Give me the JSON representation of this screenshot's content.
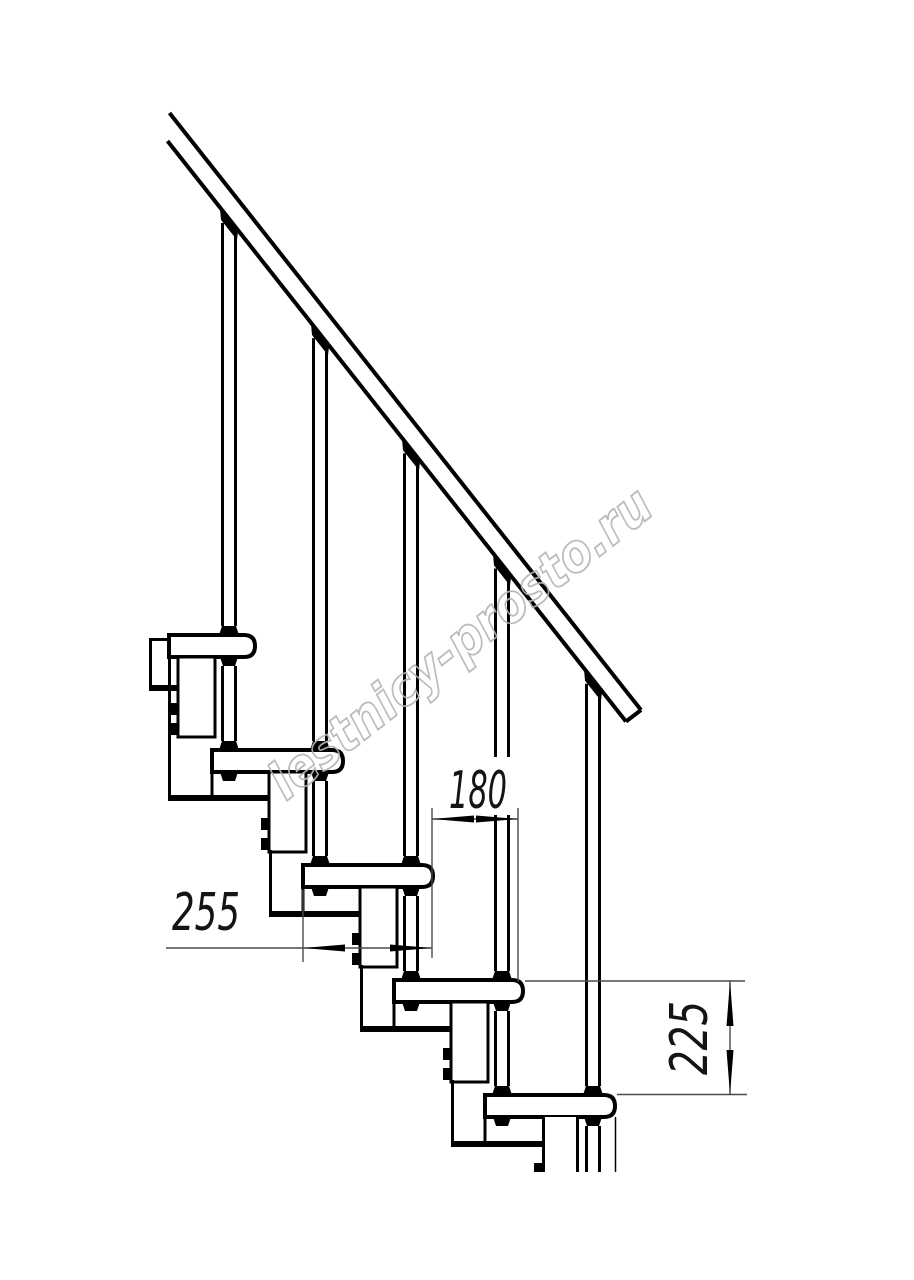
{
  "drawing": {
    "title": "modular staircase side-view technical drawing",
    "watermark": "lestnicy-prosto.ru",
    "dimensions": {
      "going_mm": "180",
      "tread_depth_mm": "255",
      "rise_mm": "225"
    },
    "module_count": 5,
    "colors": {
      "line": "#000000",
      "dim_line": "#4a4a4a",
      "dim_text": "#141414",
      "watermark": "#b4b4b4",
      "background": "#ffffff"
    }
  }
}
